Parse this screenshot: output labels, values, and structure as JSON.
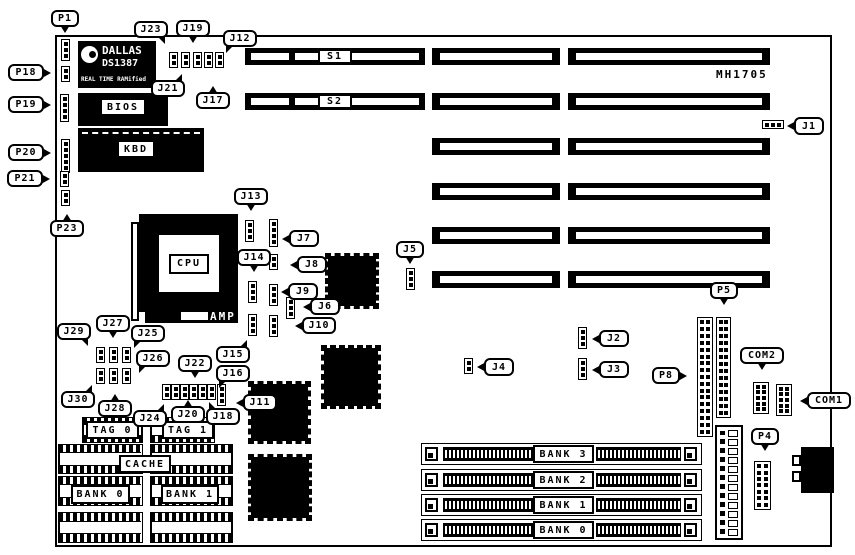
{
  "diagram": {
    "kind": "motherboard jumper/connector location diagram",
    "bg_color": "#ffffff",
    "ink_color": "#000000",
    "board_id_text": "MH1705"
  },
  "board": {
    "x": 55,
    "y": 35,
    "w": 777,
    "h": 512
  },
  "ic_labels": {
    "dallas_line1": "DALLAS",
    "dallas_line2": "DS1387",
    "dallas_line3": "REAL TIME RAMified",
    "bios": "BIOS",
    "kbd": "KBD",
    "cpu": "CPU",
    "amp": "AMP"
  },
  "callouts": [
    {
      "id": "p1",
      "label": "P1",
      "x": 51,
      "y": 10,
      "w": 28,
      "h": 17,
      "tail": "b"
    },
    {
      "id": "p18",
      "label": "P18",
      "x": 8,
      "y": 64,
      "w": 36,
      "h": 17,
      "tail": "r"
    },
    {
      "id": "p19",
      "label": "P19",
      "x": 8,
      "y": 96,
      "w": 36,
      "h": 17,
      "tail": "r"
    },
    {
      "id": "p20",
      "label": "P20",
      "x": 8,
      "y": 144,
      "w": 36,
      "h": 17,
      "tail": "r"
    },
    {
      "id": "p21",
      "label": "P21",
      "x": 7,
      "y": 170,
      "w": 36,
      "h": 17,
      "tail": "r"
    },
    {
      "id": "p23",
      "label": "P23",
      "x": 50,
      "y": 220,
      "w": 34,
      "h": 17,
      "tail": "t"
    },
    {
      "id": "j23",
      "label": "J23",
      "x": 134,
      "y": 21,
      "w": 34,
      "h": 17,
      "tail": "br"
    },
    {
      "id": "j19",
      "label": "J19",
      "x": 176,
      "y": 20,
      "w": 34,
      "h": 17,
      "tail": "b"
    },
    {
      "id": "j12",
      "label": "J12",
      "x": 223,
      "y": 30,
      "w": 34,
      "h": 17,
      "tail": "bl"
    },
    {
      "id": "j21",
      "label": "J21",
      "x": 151,
      "y": 80,
      "w": 34,
      "h": 17,
      "tail": "tr"
    },
    {
      "id": "j17",
      "label": "J17",
      "x": 196,
      "y": 92,
      "w": 34,
      "h": 17,
      "tail": "t"
    },
    {
      "id": "j1",
      "label": "J1",
      "x": 794,
      "y": 117,
      "w": 30,
      "h": 18,
      "tail": "l"
    },
    {
      "id": "j13",
      "label": "J13",
      "x": 234,
      "y": 188,
      "w": 34,
      "h": 17,
      "tail": "b"
    },
    {
      "id": "j7",
      "label": "J7",
      "x": 289,
      "y": 230,
      "w": 30,
      "h": 17,
      "tail": "l"
    },
    {
      "id": "j14",
      "label": "J14",
      "x": 237,
      "y": 249,
      "w": 34,
      "h": 17,
      "tail": "b"
    },
    {
      "id": "j8",
      "label": "J8",
      "x": 297,
      "y": 256,
      "w": 30,
      "h": 17,
      "tail": "l"
    },
    {
      "id": "j9",
      "label": "J9",
      "x": 288,
      "y": 283,
      "w": 30,
      "h": 17,
      "tail": "l"
    },
    {
      "id": "j6",
      "label": "J6",
      "x": 310,
      "y": 298,
      "w": 30,
      "h": 17,
      "tail": "l"
    },
    {
      "id": "j10",
      "label": "J10",
      "x": 302,
      "y": 317,
      "w": 34,
      "h": 17,
      "tail": "l"
    },
    {
      "id": "j5",
      "label": "J5",
      "x": 396,
      "y": 241,
      "w": 28,
      "h": 17,
      "tail": "b"
    },
    {
      "id": "j29",
      "label": "J29",
      "x": 57,
      "y": 323,
      "w": 34,
      "h": 17,
      "tail": "br"
    },
    {
      "id": "j27",
      "label": "J27",
      "x": 96,
      "y": 315,
      "w": 34,
      "h": 17,
      "tail": "b"
    },
    {
      "id": "j25",
      "label": "J25",
      "x": 131,
      "y": 325,
      "w": 34,
      "h": 17,
      "tail": "bl"
    },
    {
      "id": "j26",
      "label": "J26",
      "x": 136,
      "y": 350,
      "w": 34,
      "h": 17,
      "tail": "bl"
    },
    {
      "id": "j30",
      "label": "J30",
      "x": 61,
      "y": 391,
      "w": 34,
      "h": 17,
      "tail": "tr"
    },
    {
      "id": "j28",
      "label": "J28",
      "x": 98,
      "y": 400,
      "w": 34,
      "h": 17,
      "tail": "t"
    },
    {
      "id": "j22",
      "label": "J22",
      "x": 178,
      "y": 355,
      "w": 34,
      "h": 17,
      "tail": "b"
    },
    {
      "id": "j15",
      "label": "J15",
      "x": 216,
      "y": 346,
      "w": 34,
      "h": 17,
      "tail": "tr"
    },
    {
      "id": "j16",
      "label": "J16",
      "x": 216,
      "y": 365,
      "w": 34,
      "h": 17,
      "tail": "bl"
    },
    {
      "id": "j24",
      "label": "J24",
      "x": 133,
      "y": 410,
      "w": 34,
      "h": 17,
      "tail": "tr"
    },
    {
      "id": "j20",
      "label": "J20",
      "x": 171,
      "y": 406,
      "w": 34,
      "h": 17,
      "tail": "t"
    },
    {
      "id": "j18",
      "label": "J18",
      "x": 206,
      "y": 408,
      "w": 34,
      "h": 17,
      "tail": "tl"
    },
    {
      "id": "j11",
      "label": "J11",
      "x": 243,
      "y": 394,
      "w": 34,
      "h": 17,
      "tail": "l"
    },
    {
      "id": "j4",
      "label": "J4",
      "x": 484,
      "y": 358,
      "w": 30,
      "h": 18,
      "tail": "l"
    },
    {
      "id": "j2",
      "label": "J2",
      "x": 599,
      "y": 330,
      "w": 30,
      "h": 17,
      "tail": "l"
    },
    {
      "id": "j3",
      "label": "J3",
      "x": 599,
      "y": 361,
      "w": 30,
      "h": 17,
      "tail": "l"
    },
    {
      "id": "p5",
      "label": "P5",
      "x": 710,
      "y": 282,
      "w": 28,
      "h": 17,
      "tail": "b"
    },
    {
      "id": "p8",
      "label": "P8",
      "x": 652,
      "y": 367,
      "w": 28,
      "h": 17,
      "tail": "r"
    },
    {
      "id": "com2",
      "label": "COM2",
      "x": 740,
      "y": 347,
      "w": 44,
      "h": 17,
      "tail": "b"
    },
    {
      "id": "com1",
      "label": "COM1",
      "x": 807,
      "y": 392,
      "w": 44,
      "h": 17,
      "tail": "l"
    },
    {
      "id": "p4",
      "label": "P4",
      "x": 751,
      "y": 428,
      "w": 28,
      "h": 17,
      "tail": "b"
    }
  ],
  "slots": [
    {
      "id": "s1",
      "label": "S1",
      "x": 245,
      "y": 48,
      "w": 180,
      "h": 17,
      "segs": [
        [
          6,
          38
        ],
        [
          50,
          124
        ]
      ]
    },
    {
      "id": "s2",
      "label": "S2",
      "x": 245,
      "y": 93,
      "w": 180,
      "h": 17,
      "segs": [
        [
          6,
          38
        ],
        [
          50,
          124
        ]
      ]
    },
    {
      "id": "mid-1",
      "x": 432,
      "y": 48,
      "w": 128,
      "h": 17,
      "segs": [
        [
          8,
          112
        ]
      ]
    },
    {
      "id": "mid-2",
      "x": 432,
      "y": 93,
      "w": 128,
      "h": 17,
      "segs": [
        [
          8,
          112
        ]
      ]
    },
    {
      "id": "mid-3",
      "x": 432,
      "y": 138,
      "w": 128,
      "h": 17,
      "segs": [
        [
          8,
          112
        ]
      ]
    },
    {
      "id": "mid-4",
      "x": 432,
      "y": 183,
      "w": 128,
      "h": 17,
      "segs": [
        [
          8,
          112
        ]
      ]
    },
    {
      "id": "mid-5",
      "x": 432,
      "y": 227,
      "w": 128,
      "h": 17,
      "segs": [
        [
          8,
          112
        ]
      ]
    },
    {
      "id": "mid-6",
      "x": 432,
      "y": 271,
      "w": 128,
      "h": 17,
      "segs": [
        [
          8,
          112
        ]
      ]
    },
    {
      "id": "right-1",
      "x": 568,
      "y": 48,
      "w": 202,
      "h": 17,
      "segs": [
        [
          8,
          186
        ]
      ]
    },
    {
      "id": "right-2",
      "x": 568,
      "y": 93,
      "w": 202,
      "h": 17,
      "segs": [
        [
          8,
          186
        ]
      ]
    },
    {
      "id": "right-3",
      "x": 568,
      "y": 138,
      "w": 202,
      "h": 17,
      "segs": [
        [
          8,
          186
        ]
      ]
    },
    {
      "id": "right-4",
      "x": 568,
      "y": 183,
      "w": 202,
      "h": 17,
      "segs": [
        [
          8,
          186
        ]
      ]
    },
    {
      "id": "right-5",
      "x": 568,
      "y": 227,
      "w": 202,
      "h": 17,
      "segs": [
        [
          8,
          186
        ]
      ]
    },
    {
      "id": "right-6",
      "x": 568,
      "y": 271,
      "w": 202,
      "h": 17,
      "segs": [
        [
          8,
          186
        ]
      ]
    }
  ],
  "jumpers": [
    {
      "id": "p1",
      "x": 61,
      "y": 39,
      "pins": 3
    },
    {
      "id": "p18",
      "x": 61,
      "y": 66,
      "pins": 2
    },
    {
      "id": "p19",
      "x": 60,
      "y": 94,
      "pins": 4
    },
    {
      "id": "p20",
      "x": 61,
      "y": 139,
      "pins": 5
    },
    {
      "id": "p21",
      "x": 60,
      "y": 171,
      "pins": 2
    },
    {
      "id": "p23",
      "x": 61,
      "y": 190,
      "pins": 2
    },
    {
      "id": "j23",
      "x": 169,
      "y": 52,
      "pins": 2
    },
    {
      "id": "j21",
      "x": 181,
      "y": 52,
      "pins": 2
    },
    {
      "id": "j19",
      "x": 193,
      "y": 52,
      "pins": 2
    },
    {
      "id": "j17",
      "x": 204,
      "y": 52,
      "pins": 2
    },
    {
      "id": "j12",
      "x": 215,
      "y": 52,
      "pins": 2
    },
    {
      "id": "j13",
      "x": 245,
      "y": 220,
      "pins": 3
    },
    {
      "id": "j7",
      "x": 269,
      "y": 219,
      "pins": 4
    },
    {
      "id": "j14",
      "x": 248,
      "y": 281,
      "pins": 3
    },
    {
      "id": "j8",
      "x": 269,
      "y": 254,
      "pins": 2
    },
    {
      "id": "j9",
      "x": 269,
      "y": 284,
      "pins": 3
    },
    {
      "id": "j6",
      "x": 286,
      "y": 297,
      "pins": 3
    },
    {
      "id": "j10",
      "x": 269,
      "y": 315,
      "pins": 3
    },
    {
      "id": "j15",
      "x": 248,
      "y": 314,
      "pins": 3
    },
    {
      "id": "j29",
      "x": 96,
      "y": 347,
      "pins": 2
    },
    {
      "id": "j27",
      "x": 109,
      "y": 347,
      "pins": 2
    },
    {
      "id": "j25",
      "x": 122,
      "y": 347,
      "pins": 2
    },
    {
      "id": "j30",
      "x": 96,
      "y": 368,
      "pins": 2
    },
    {
      "id": "j28",
      "x": 109,
      "y": 368,
      "pins": 2
    },
    {
      "id": "j26",
      "x": 122,
      "y": 368,
      "pins": 2
    },
    {
      "id": "j24",
      "x": 162,
      "y": 384,
      "pins": 2
    },
    {
      "id": "j22",
      "x": 171,
      "y": 384,
      "pins": 2
    },
    {
      "id": "j20a",
      "x": 180,
      "y": 384,
      "pins": 2
    },
    {
      "id": "j20b",
      "x": 189,
      "y": 384,
      "pins": 2
    },
    {
      "id": "j18",
      "x": 198,
      "y": 384,
      "pins": 2
    },
    {
      "id": "j16",
      "x": 207,
      "y": 384,
      "pins": 2
    },
    {
      "id": "j11",
      "x": 217,
      "y": 384,
      "pins": 3
    },
    {
      "id": "j5",
      "x": 406,
      "y": 268,
      "pins": 3
    },
    {
      "id": "j4",
      "x": 464,
      "y": 358,
      "pins": 2
    },
    {
      "id": "j2",
      "x": 578,
      "y": 327,
      "pins": 3
    },
    {
      "id": "j3",
      "x": 578,
      "y": 358,
      "pins": 3
    },
    {
      "id": "j1",
      "x": 762,
      "y": 120,
      "pins": 3,
      "orient": "h"
    }
  ],
  "qfp_chips": [
    {
      "id": "qfp-a",
      "x": 325,
      "y": 253,
      "w": 54,
      "h": 56
    },
    {
      "id": "qfp-b",
      "x": 321,
      "y": 345,
      "w": 60,
      "h": 64
    },
    {
      "id": "qfp-c",
      "x": 248,
      "y": 381,
      "w": 63,
      "h": 63
    },
    {
      "id": "qfp-d",
      "x": 248,
      "y": 454,
      "w": 64,
      "h": 67
    }
  ],
  "dip_chips": [
    {
      "id": "tag0-chip",
      "x": 82,
      "y": 417,
      "w": 61,
      "h": 26
    },
    {
      "id": "tag1-chip",
      "x": 150,
      "y": 417,
      "w": 65,
      "h": 26
    },
    {
      "id": "cache-l1",
      "x": 58,
      "y": 444,
      "w": 85,
      "h": 30
    },
    {
      "id": "cache-l2",
      "x": 58,
      "y": 476,
      "w": 85,
      "h": 30
    },
    {
      "id": "cache-l3",
      "x": 58,
      "y": 512,
      "w": 85,
      "h": 31
    },
    {
      "id": "cache-r1",
      "x": 150,
      "y": 444,
      "w": 83,
      "h": 30
    },
    {
      "id": "cache-r2",
      "x": 150,
      "y": 476,
      "w": 83,
      "h": 30
    },
    {
      "id": "cache-r3",
      "x": 150,
      "y": 512,
      "w": 83,
      "h": 31
    }
  ],
  "dip_labels": [
    {
      "id": "tag0",
      "label": "TAG 0",
      "x": 86,
      "y": 421,
      "w": 53,
      "h": 18
    },
    {
      "id": "tag1",
      "label": "TAG 1",
      "x": 162,
      "y": 421,
      "w": 52,
      "h": 18
    },
    {
      "id": "cache",
      "label": "CACHE",
      "x": 119,
      "y": 455,
      "w": 52,
      "h": 18
    },
    {
      "id": "bank0-cache",
      "label": "BANK 0",
      "x": 71,
      "y": 485,
      "w": 59,
      "h": 19
    },
    {
      "id": "bank1-cache",
      "label": "BANK 1",
      "x": 161,
      "y": 485,
      "w": 58,
      "h": 19
    }
  ],
  "simms": [
    {
      "id": "simm-bank3",
      "label": "BANK 3",
      "y": 443
    },
    {
      "id": "simm-bank2",
      "label": "BANK 2",
      "y": 469
    },
    {
      "id": "simm-bank1",
      "label": "BANK 1",
      "y": 494
    },
    {
      "id": "simm-bank0",
      "label": "BANK 0",
      "y": 519
    }
  ],
  "simm_geometry": {
    "x": 421,
    "w": 281,
    "h": 22
  },
  "pin_headers": [
    {
      "id": "p8",
      "x": 697,
      "y": 317,
      "w": 16,
      "h": 120,
      "rows": 17
    },
    {
      "id": "p5",
      "x": 716,
      "y": 317,
      "w": 15,
      "h": 101,
      "rows": 14
    },
    {
      "id": "com2",
      "x": 753,
      "y": 382,
      "w": 16,
      "h": 32,
      "rows": 5
    },
    {
      "id": "com1",
      "x": 776,
      "y": 384,
      "w": 16,
      "h": 32,
      "rows": 5
    },
    {
      "id": "p4",
      "x": 754,
      "y": 461,
      "w": 17,
      "h": 49,
      "rows": 7
    }
  ],
  "power_connector": {
    "x": 715,
    "y": 425,
    "w": 28,
    "h": 115,
    "cells": 12
  },
  "din_connector": {
    "x": 801,
    "y": 447,
    "w": 33,
    "h": 46
  }
}
